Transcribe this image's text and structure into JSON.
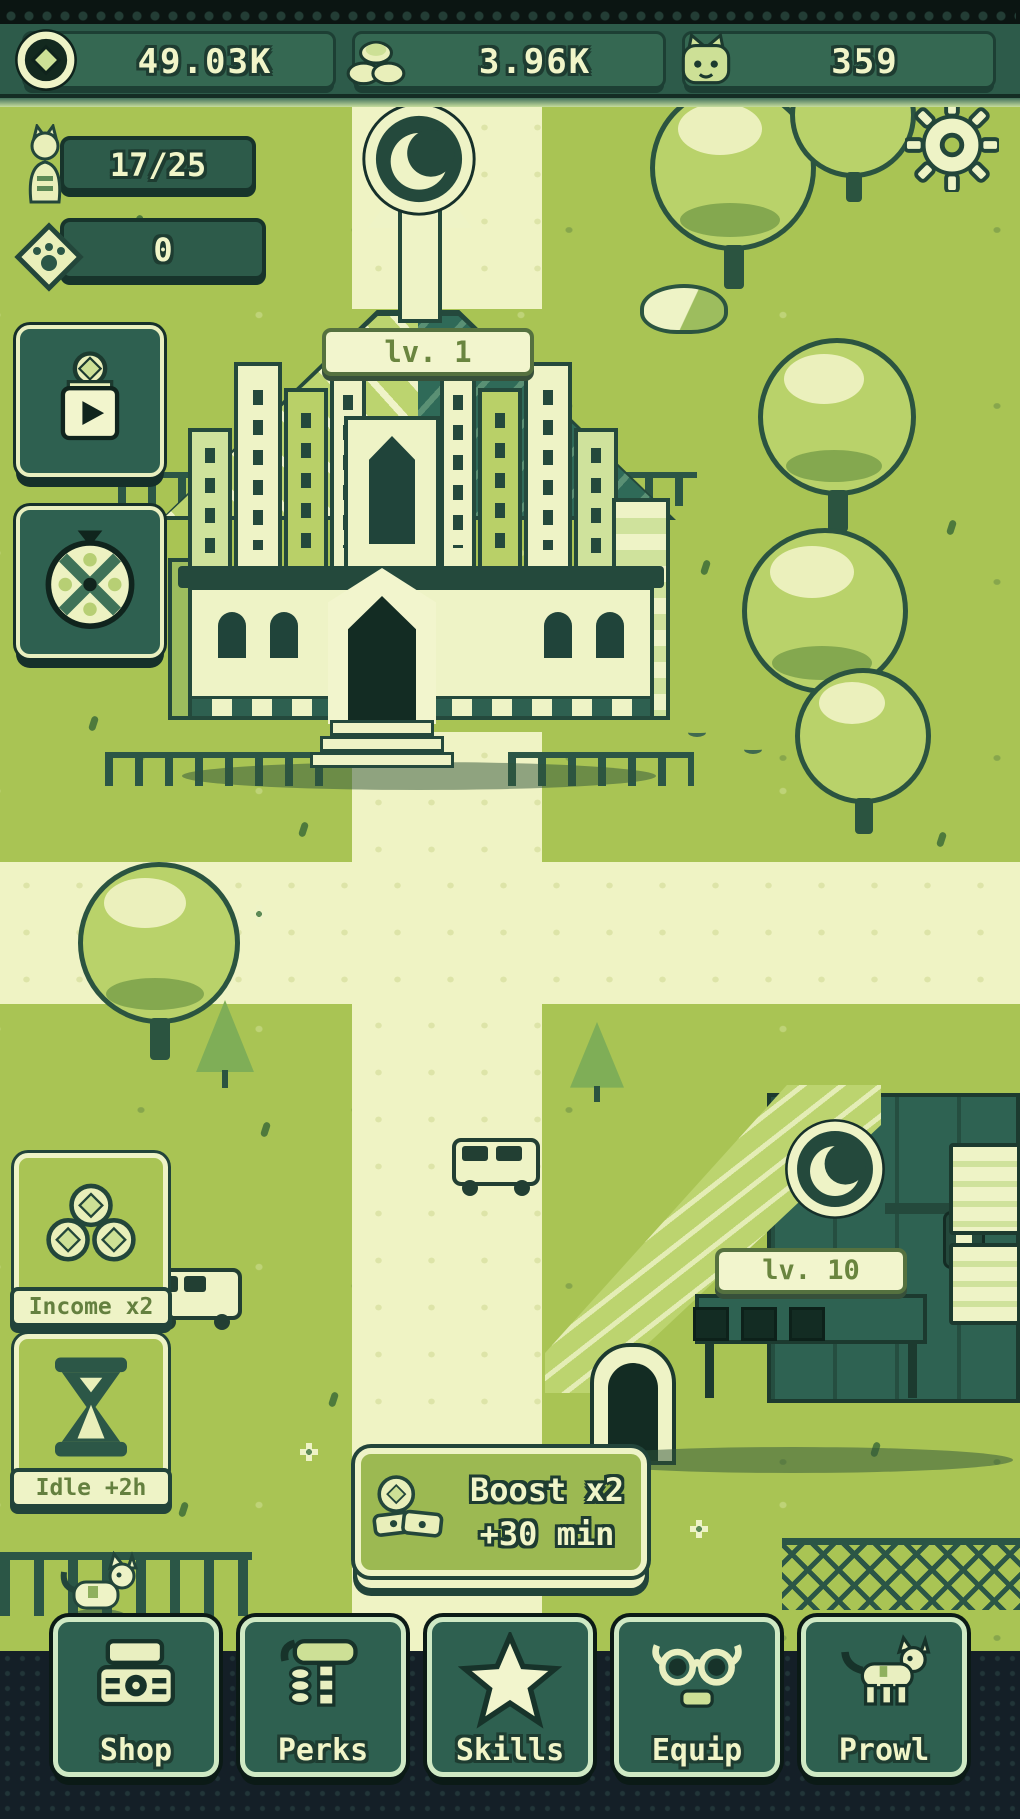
{
  "palette": {
    "bezel": "#0b1512",
    "panel": "#2d5b4a",
    "panel_dark": "#17342b",
    "cream": "#f1f5c8",
    "grass": "#a9c454",
    "path": "#eff3c4",
    "leaf": "#b9d26a",
    "teal_dark": "#2e6252",
    "navy": "#141f27",
    "accent_green": "#cde096"
  },
  "status_bar": {
    "counters": [
      {
        "name": "gems",
        "icon": "gem-icon",
        "value": "49.03K"
      },
      {
        "name": "coins",
        "icon": "coins-icon",
        "value": "3.96K"
      },
      {
        "name": "cats",
        "icon": "cat-face-icon",
        "value": "359"
      }
    ]
  },
  "hud": {
    "cats_badge": {
      "icon": "cat-statue-icon",
      "value": "17/25"
    },
    "tickets_badge": {
      "icon": "paw-diamond-icon",
      "value": "0"
    },
    "settings": {
      "icon": "gear-icon"
    }
  },
  "side_buttons": {
    "ad_reward": {
      "icon": "video-reward-icon"
    },
    "spin": {
      "icon": "spin-wheel-icon"
    }
  },
  "scene": {
    "cathedral": {
      "level_label": "lv. 1",
      "sign": "crescent-cat-sign"
    },
    "shop": {
      "level_label": "lv. 10",
      "sign": "crescent-cat-sign"
    }
  },
  "boosts": {
    "income": {
      "label": "Income x2",
      "icon": "coin-pile-icon"
    },
    "idle": {
      "label": "Idle +2h",
      "icon": "hourglass-icon"
    },
    "banner": {
      "title": "Boost x2",
      "subtitle": "+30 min",
      "icon": "coin-money-icon"
    }
  },
  "nav": {
    "items": [
      {
        "label": "Shop",
        "icon": "cash-register-icon"
      },
      {
        "label": "Perks",
        "icon": "hammer-icon"
      },
      {
        "label": "Skills",
        "icon": "star-icon"
      },
      {
        "label": "Equip",
        "icon": "glasses-icon"
      },
      {
        "label": "Prowl",
        "icon": "cat-walking-icon"
      }
    ]
  }
}
